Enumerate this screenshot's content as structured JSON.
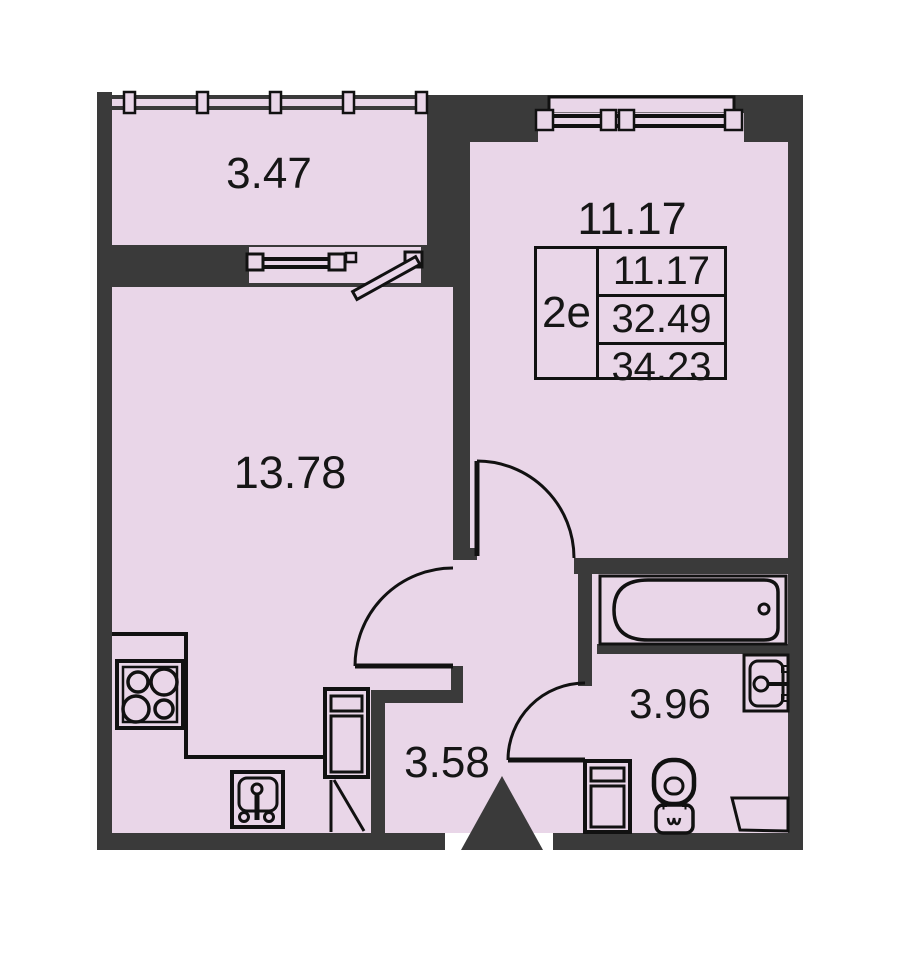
{
  "title": "Apartment floor plan",
  "info_box": {
    "type_label": "2е",
    "living_area": "11.17",
    "area_no_balcony": "32.49",
    "total_area": "34.23"
  },
  "rooms": {
    "balcony": "3.47",
    "room": "11.17",
    "living_kitchen": "13.78",
    "hallway": "3.58",
    "bathroom": "3.96"
  },
  "fixtures": [
    "stove-icon",
    "kitchen-sink-icon",
    "fridge-icon",
    "bathtub-icon",
    "bath-sink-icon",
    "washing-machine-icon",
    "toilet-icon",
    "entrance-arrow-icon",
    "window-icon",
    "door-swing-icon"
  ],
  "colors": {
    "floor": "#e9d6e8",
    "wall": "#3a3a3a",
    "line": "#111111",
    "background": "#ffffff"
  }
}
